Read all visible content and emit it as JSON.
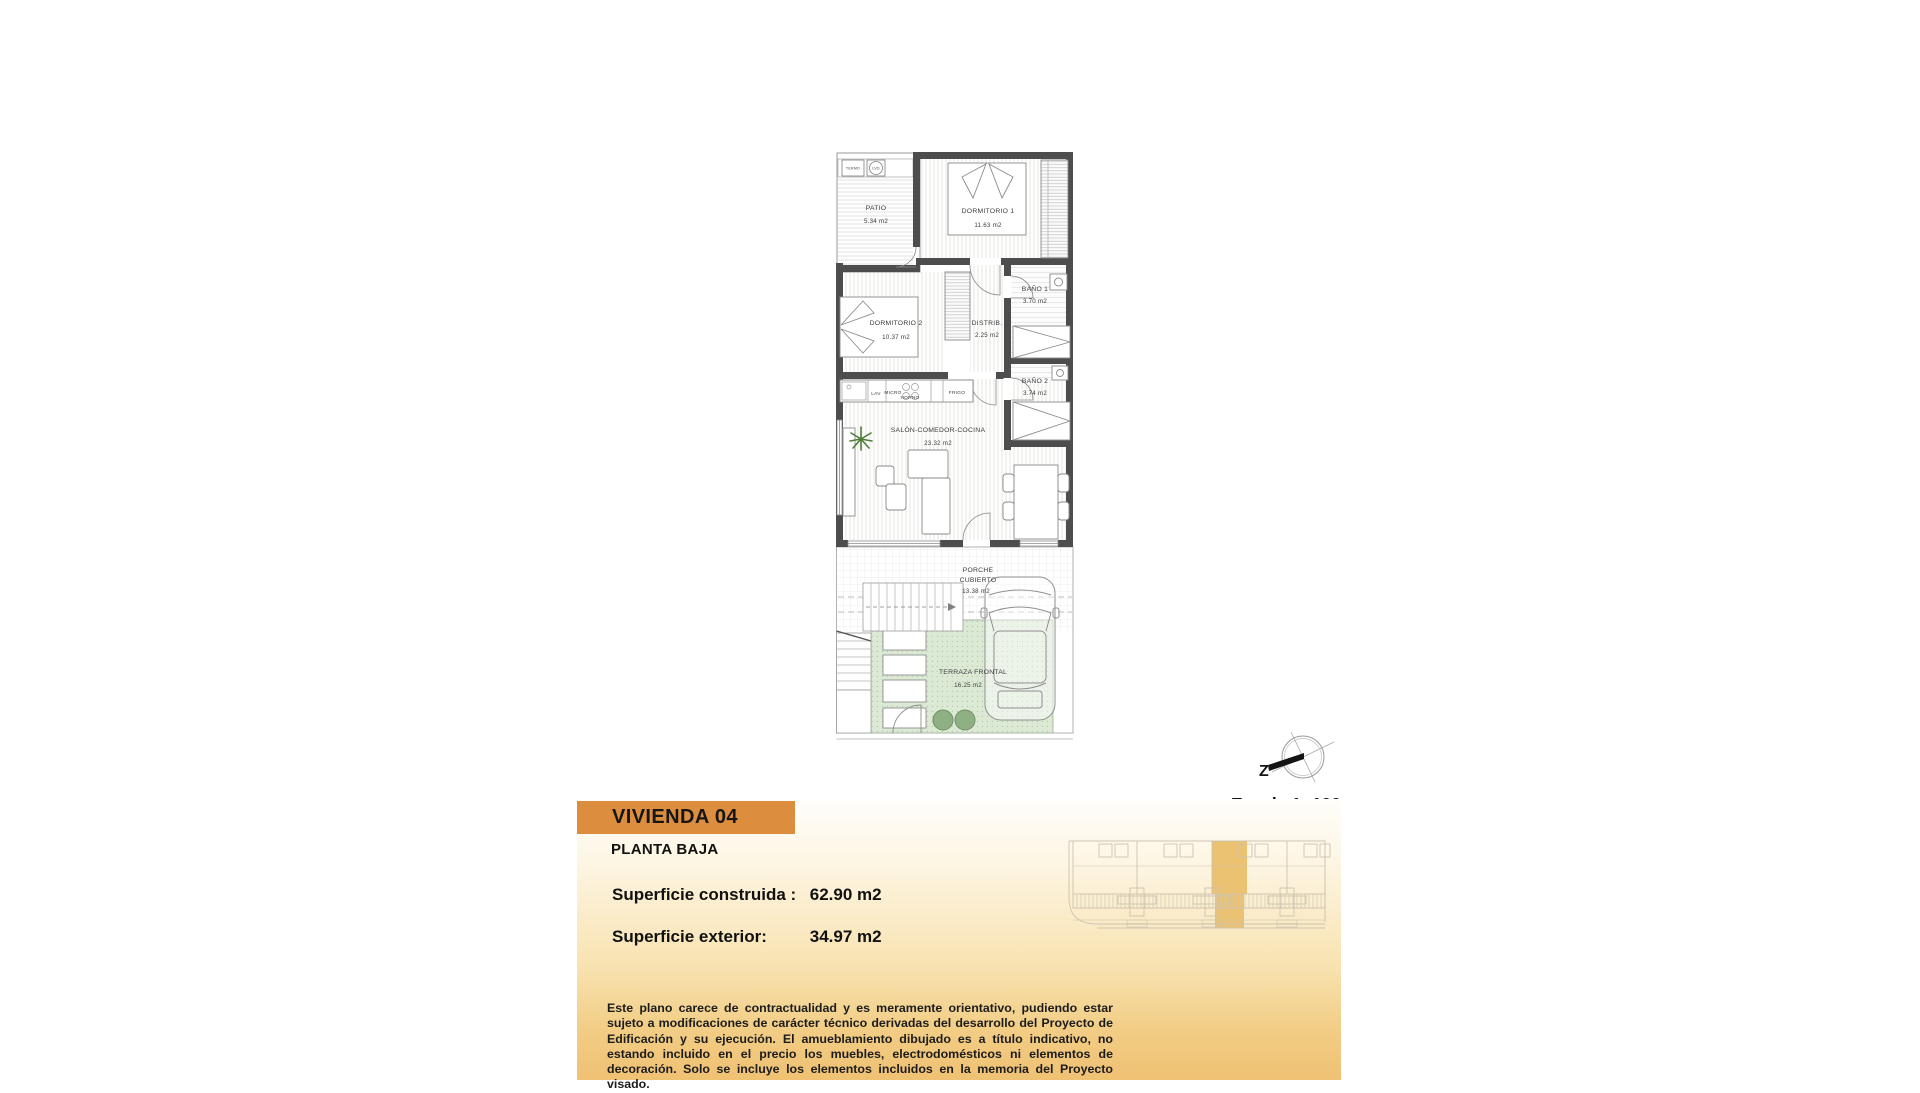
{
  "plan": {
    "rooms": {
      "patio": {
        "name": "PATIO",
        "area": "5.34 m2"
      },
      "dormitorio1": {
        "name": "DORMITORIO 1",
        "area": "11.63 m2"
      },
      "bano1": {
        "name": "BAÑO 1",
        "area": "3.70 m2"
      },
      "dormitorio2": {
        "name": "DORMITORIO 2",
        "area": "10.37 m2"
      },
      "distribuidor": {
        "name": "DISTRIB.",
        "area": "2.25 m2"
      },
      "bano2": {
        "name": "BAÑO 2",
        "area": "3.74 m2"
      },
      "salon": {
        "name": "SALÓN-COMEDOR-COCINA",
        "area": "23.32 m2"
      },
      "porche": {
        "line1": "PORCHE",
        "line2": "CUBIERTO",
        "area": "13.38 m2"
      },
      "terraza": {
        "name": "TERRAZA FRONTAL",
        "area": "16.25 m2"
      }
    },
    "kitchen_labels": {
      "lav": "LAV",
      "micro": "MICRO",
      "horno": "HORNO",
      "frigo": "FRIGO"
    },
    "utility_labels": {
      "termo": "TERMO",
      "lavadora": "LVD"
    }
  },
  "compass": {
    "north_label": "Z"
  },
  "scale_label": "Escala 1: 100",
  "footer": {
    "title": "VIVIENDA 04",
    "floor_label": "PLANTA BAJA",
    "built_area_label": "Superficie construida :",
    "built_area_value": "62.90 m2",
    "exterior_area_label": "Superficie exterior:",
    "exterior_area_value": "34.97 m2",
    "disclaimer": "Este plano carece de contractualidad y es meramente orientativo, pudiendo estar sujeto a modificaciones de carácter técnico derivadas del desarrollo del Proyecto de Edificación y su ejecución. El amueblamiento dibujado es a título indicativo, no estando incluido en el precio los muebles, electrodomésticos ni elementos de decoración. Solo se incluye los elementos incluidos en la memoria del Proyecto visado."
  },
  "colors": {
    "accent_orange": "#DC8E3E",
    "highlight_gold": "#EBC172",
    "terrace_green": "#DCE9D5",
    "panel_gradient_bottom": "#EFC173"
  }
}
